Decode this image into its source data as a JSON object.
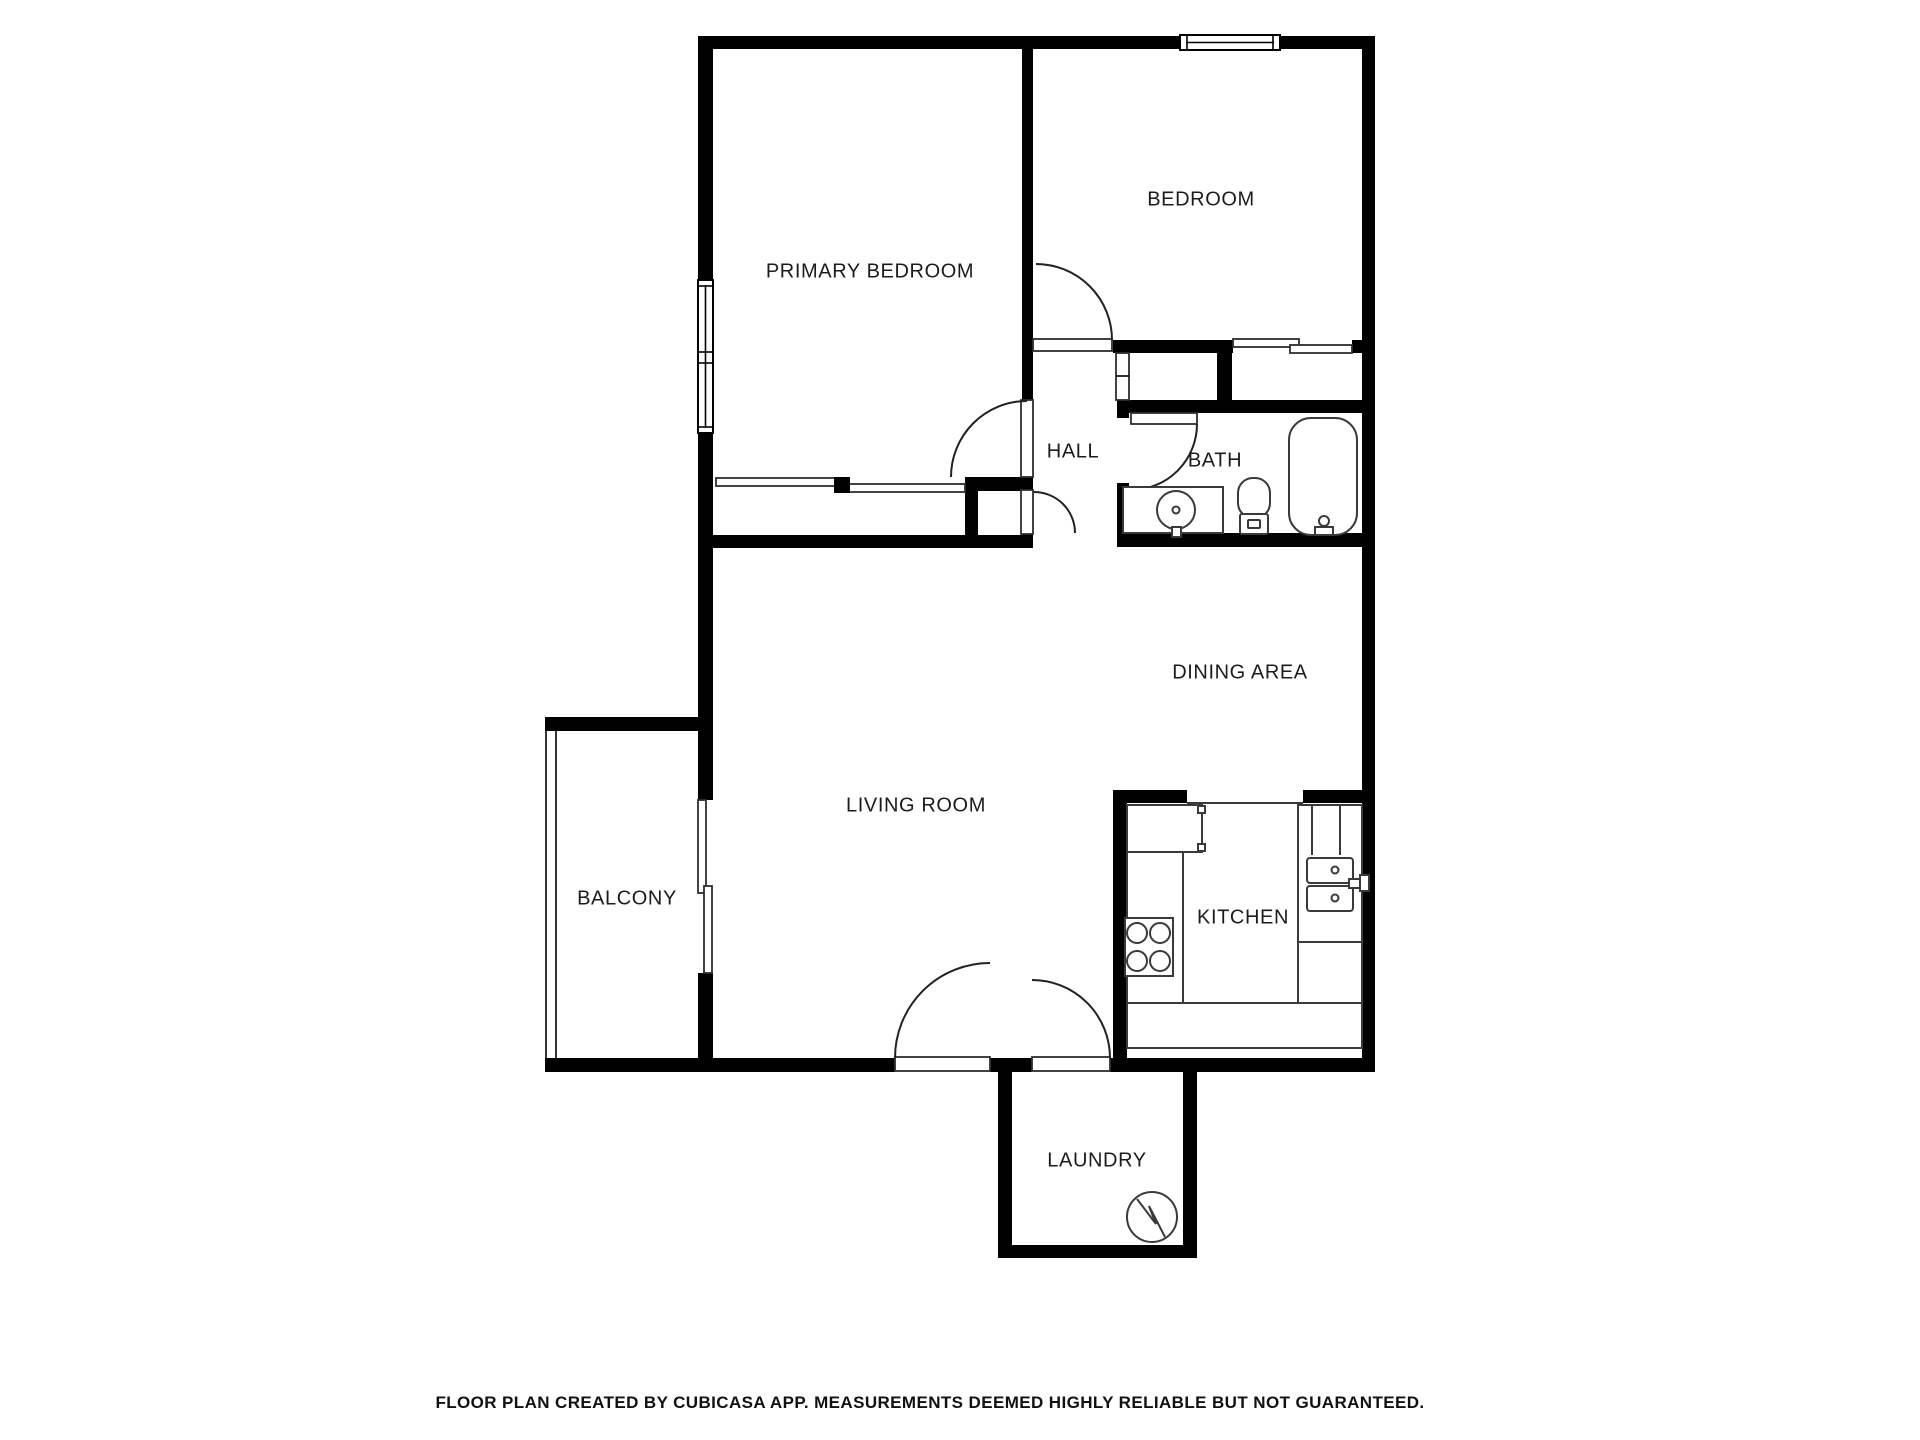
{
  "colors": {
    "wall": "#000000",
    "fixture": "#3a3a3a",
    "background": "#ffffff",
    "text": "#1c1c1c"
  },
  "rooms": [
    {
      "id": "primary-bedroom",
      "label": "PRIMARY BEDROOM"
    },
    {
      "id": "bedroom",
      "label": "BEDROOM"
    },
    {
      "id": "hall",
      "label": "HALL"
    },
    {
      "id": "bath",
      "label": "BATH"
    },
    {
      "id": "dining-area",
      "label": "DINING AREA"
    },
    {
      "id": "living-room",
      "label": "LIVING ROOM"
    },
    {
      "id": "balcony",
      "label": "BALCONY"
    },
    {
      "id": "kitchen",
      "label": "KITCHEN"
    },
    {
      "id": "laundry",
      "label": "LAUNDRY"
    }
  ],
  "fixtures": [
    "window",
    "sliding-closet-door",
    "sliding-balcony-door",
    "door-swing",
    "bath-vanity-sink",
    "toilet",
    "bathtub",
    "refrigerator",
    "stove",
    "kitchen-sink",
    "kitchen-counter",
    "water-heater",
    "balcony-railing"
  ],
  "footer": {
    "text": "FLOOR PLAN CREATED BY CUBICASA APP. MEASUREMENTS DEEMED HIGHLY RELIABLE BUT NOT GUARANTEED."
  }
}
